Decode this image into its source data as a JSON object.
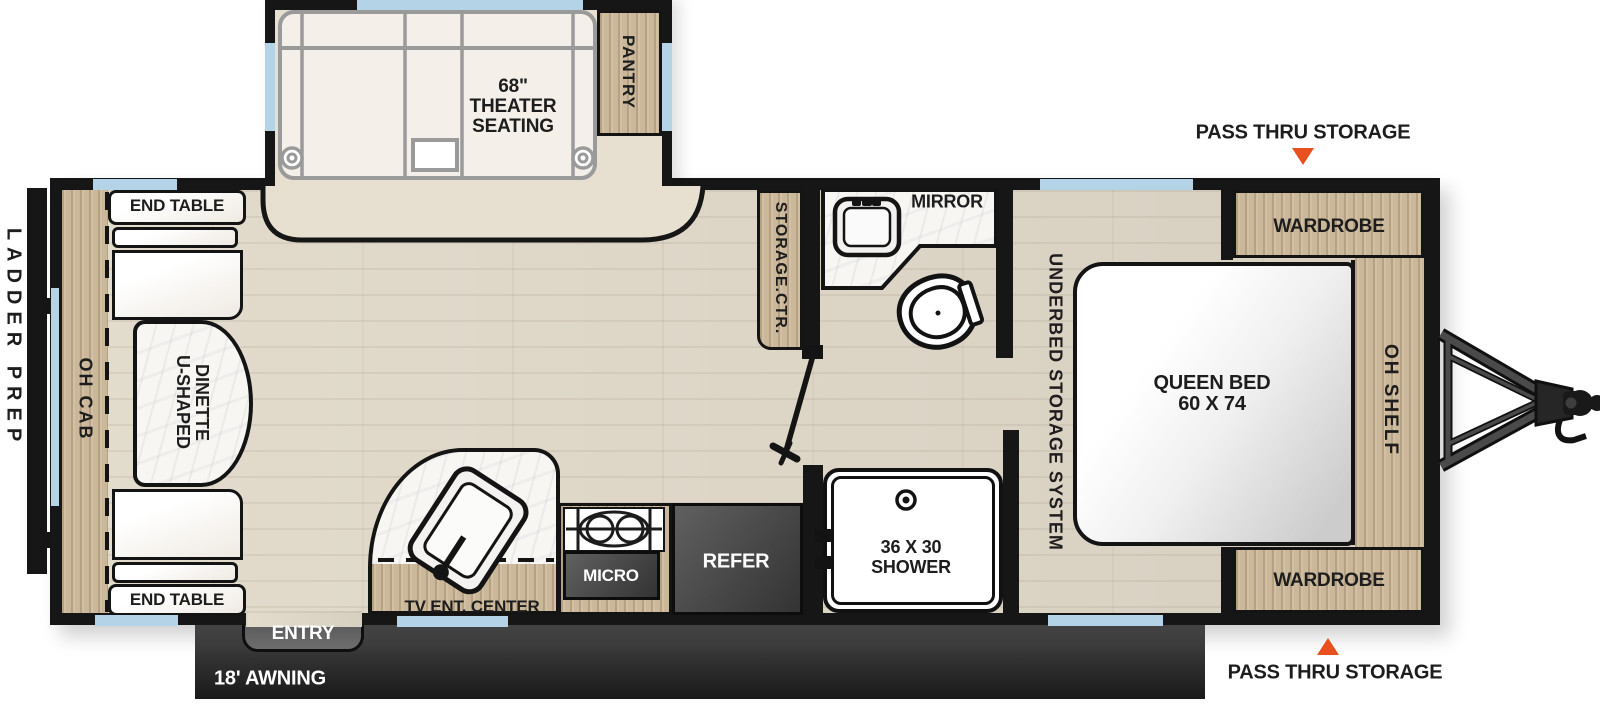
{
  "title": "Travel trailer floor plan",
  "colors": {
    "wall": "#161616",
    "wood": "#CBB89B",
    "floor": "#DDD6C8",
    "window": "#B5D3E7",
    "awning": "#303030",
    "arrow_accent": "#E8501E",
    "appliance_dark": "#4A4A4A"
  },
  "labels": {
    "pass_thru_storage_top": "PASS THRU STORAGE",
    "pass_thru_storage_bottom": "PASS THRU STORAGE",
    "ladder_prep": "LADDER PREP",
    "oh_cab": "OH CAB",
    "end_table_top": "END TABLE",
    "end_table_bottom": "END TABLE",
    "dinette_line1": "U-SHAPED",
    "dinette_line2": "DINETTE",
    "theater_line1": "68\"",
    "theater_line2": "THEATER",
    "theater_line3": "SEATING",
    "pantry": "PANTRY",
    "storage_ctr": "STORAGE.CTR.",
    "mirror": "MIRROR",
    "underbed_storage": "UNDERBED STORAGE SYSTEM",
    "queen_bed_line1": "QUEEN BED",
    "queen_bed_line2": "60 X 74",
    "oh_shelf": "OH SHELF",
    "wardrobe_top": "WARDROBE",
    "wardrobe_bottom": "WARDROBE",
    "shower_line1": "36 X 30",
    "shower_line2": "SHOWER",
    "refer": "REFER",
    "micro": "MICRO",
    "tv_ent_center": "TV ENT. CENTER",
    "entry": "ENTRY",
    "awning": "18' AWNING"
  }
}
